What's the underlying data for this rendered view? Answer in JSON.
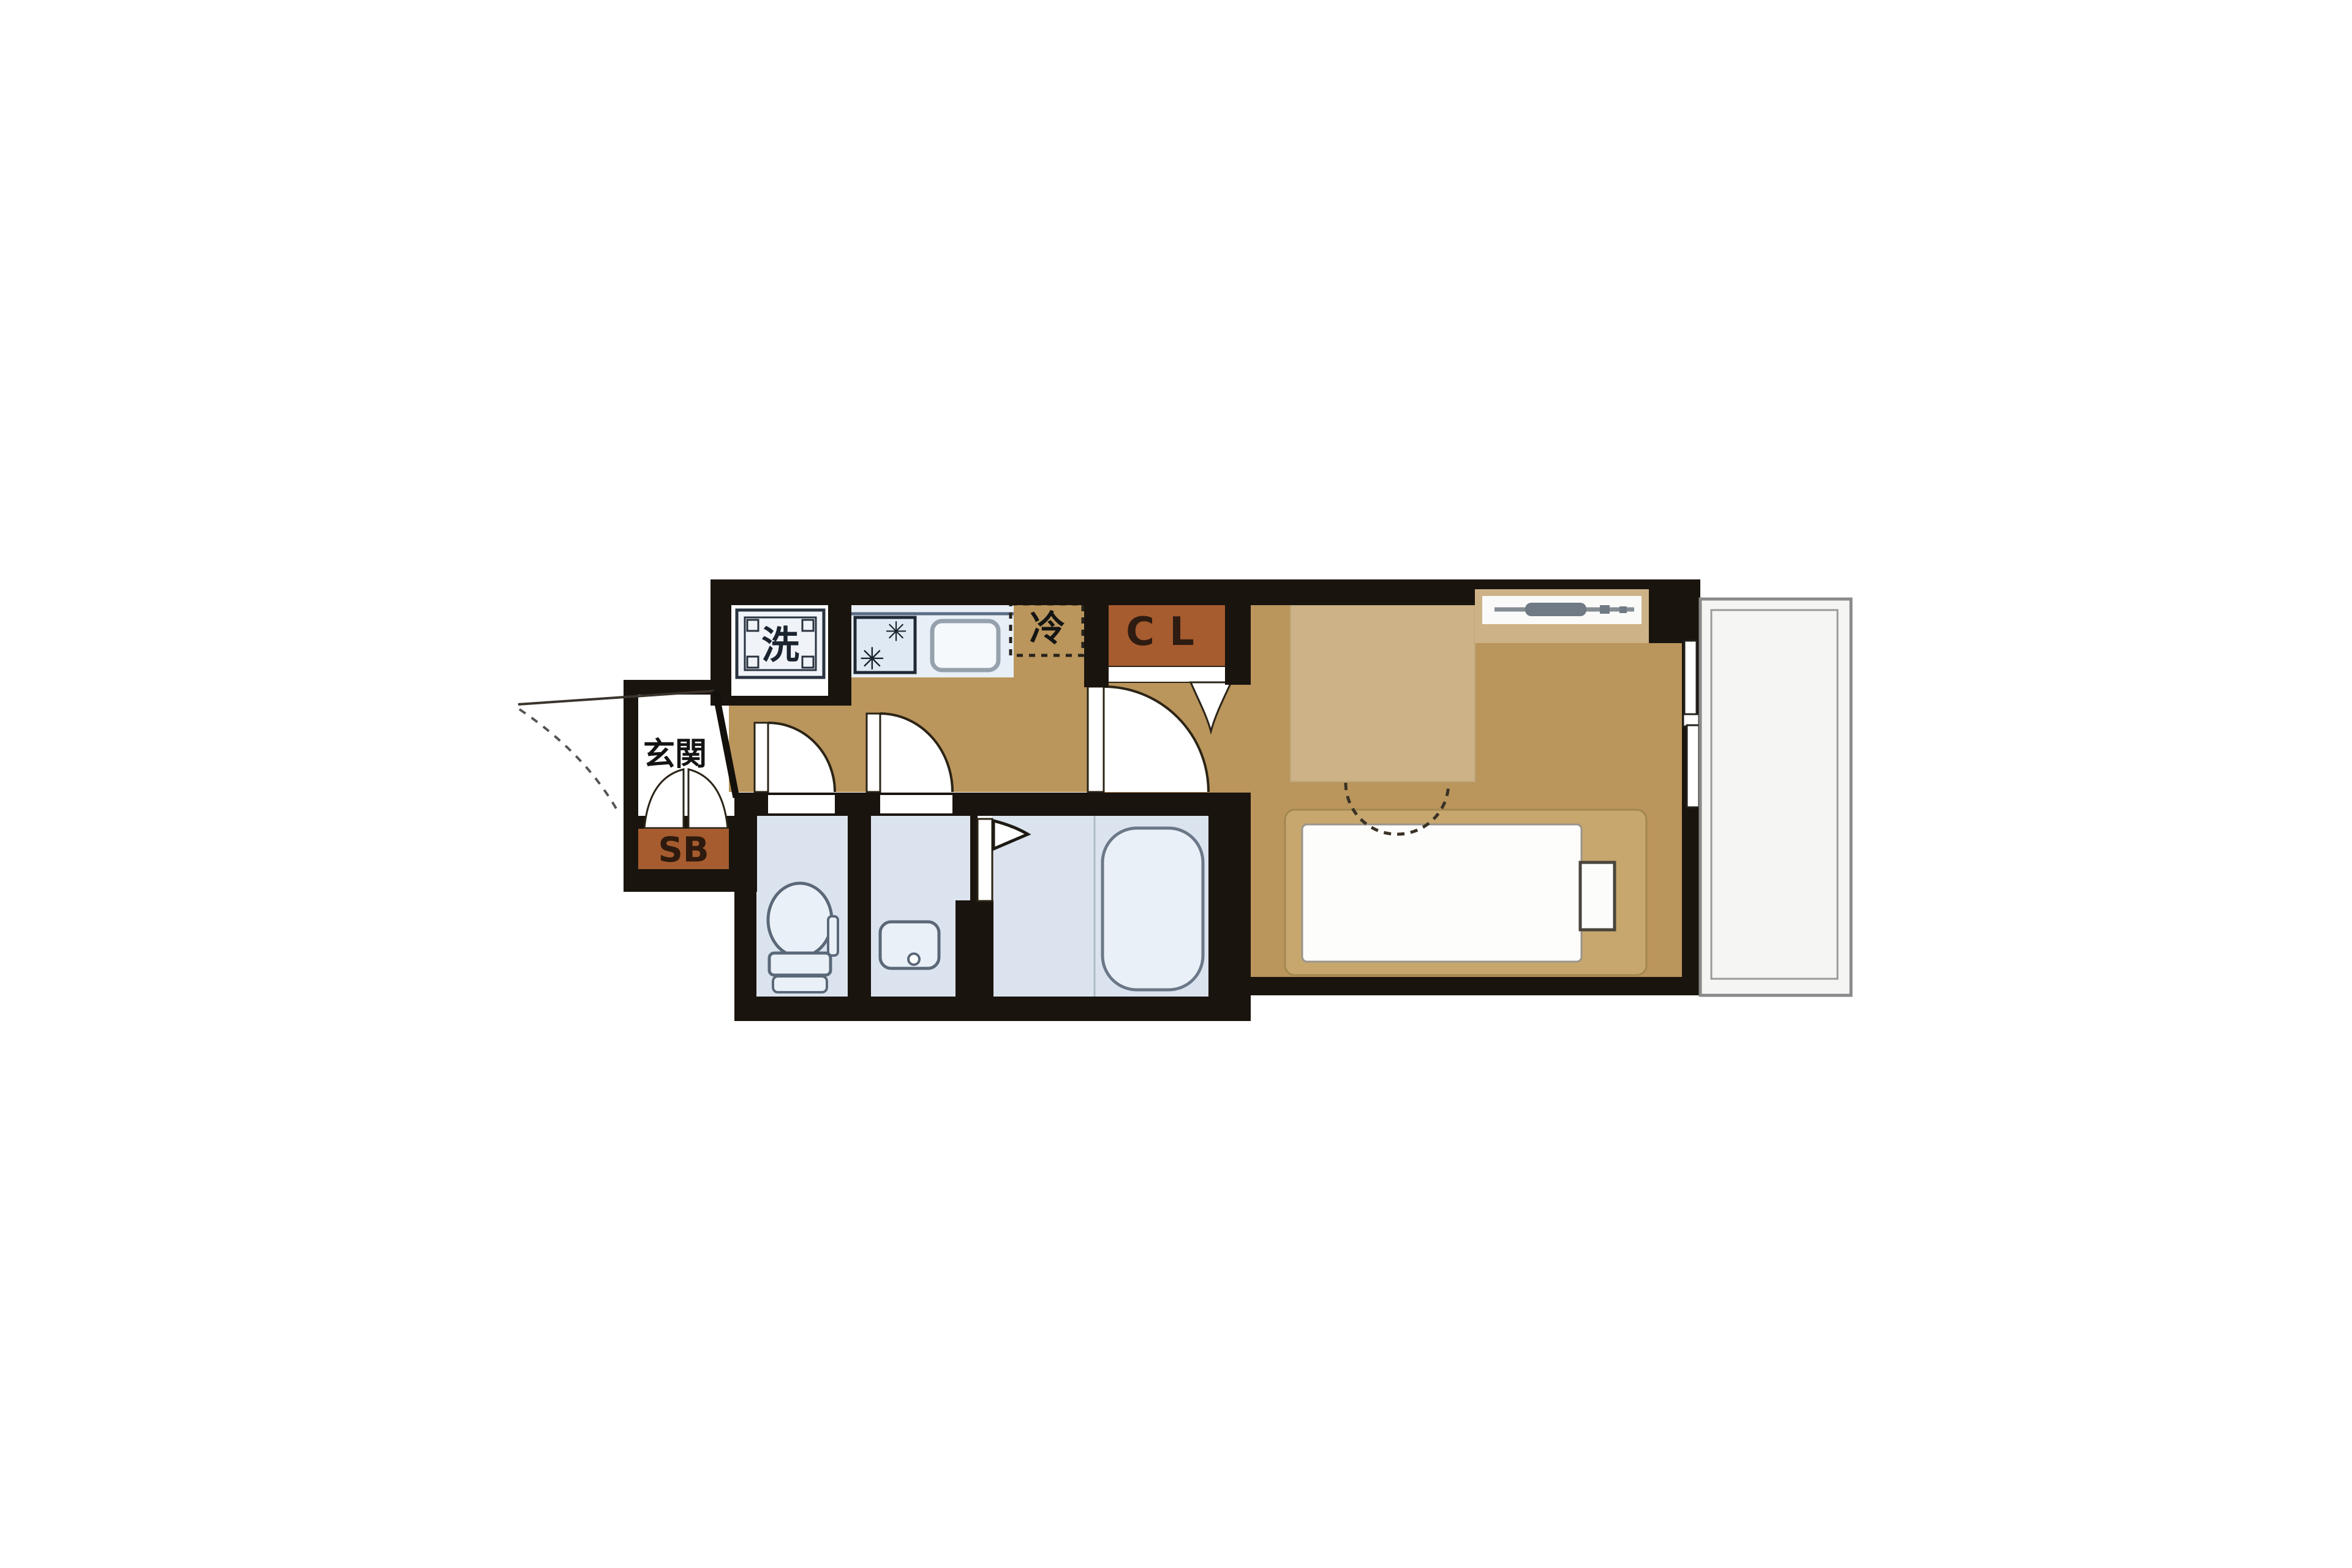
{
  "floor_plan": {
    "kind": "apartment-floor-plan",
    "labels": {
      "entrance": "玄関",
      "shoe_box": "SB",
      "closet": "CL",
      "refrigerator": "冷",
      "washing_machine": "洗"
    },
    "icons": {
      "burner": "✳"
    },
    "colors": {
      "wall": "#1A140E",
      "floor": "#BA955C",
      "furniture": "#CDB287",
      "bed_frame": "#C7A76E",
      "mattress": "#FDFDFB",
      "closet_rust": "#A65C2F",
      "wet_floor": "#DBE4EE",
      "fixture_fill": "#EAF0F7",
      "counter": "#E8EFF6",
      "balcony_line": "#8A8A8A",
      "balcony_fill": "#F5F5F3",
      "label_dark": "#1C2430",
      "text_black": "#141414",
      "closet_label": "#2E1C12",
      "shoe_box_label": "#2E1A0E",
      "window_gray": "#848C94"
    }
  }
}
